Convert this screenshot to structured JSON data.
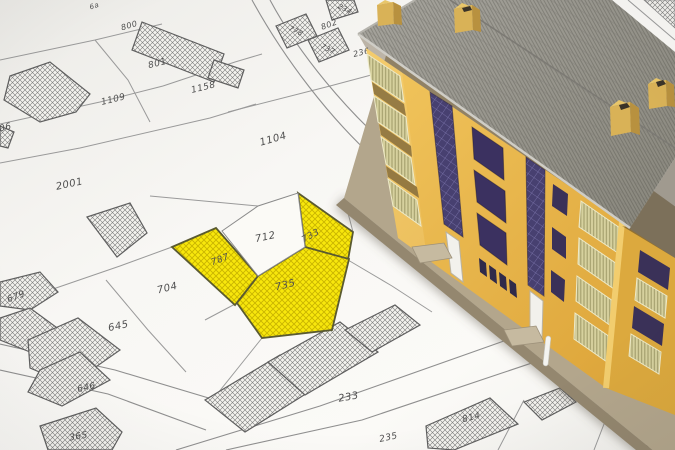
{
  "scene": {
    "title": "Model apartment building on cadastral map",
    "description": "Miniature multi-storey model house standing on a black-and-white cadastral plan; parcels 787, 733 and 735 are highlighted yellow around white parcel 712."
  },
  "map": {
    "paper_color": "#f7f6f2",
    "line_color": "#9a9a9a",
    "footprint_fill": "#f3f2ee",
    "hatch_line_color": "#7b7b7b",
    "hatch_outline_color": "#5f5f5f",
    "highlight": {
      "fill": "#f8e70c",
      "hatch": "#c9b400",
      "outline": "#5a5a30",
      "parcels": [
        "787",
        "733",
        "735"
      ],
      "surrounded_parcel": "712"
    },
    "labels": [
      {
        "text": "6a",
        "x": 95,
        "y": 8,
        "rot": -18,
        "size": 7
      },
      {
        "text": "800",
        "x": 130,
        "y": 28,
        "rot": -16,
        "size": 8
      },
      {
        "text": "802",
        "x": 330,
        "y": 27,
        "rot": -20,
        "size": 8
      },
      {
        "text": "801",
        "x": 158,
        "y": 66,
        "rot": -14,
        "size": 9
      },
      {
        "text": "1158",
        "x": 204,
        "y": 90,
        "rot": -14,
        "size": 9
      },
      {
        "text": "1109",
        "x": 114,
        "y": 102,
        "rot": -14,
        "size": 9
      },
      {
        "text": "06",
        "x": 6,
        "y": 130,
        "rot": -14,
        "size": 9
      },
      {
        "text": "1104",
        "x": 274,
        "y": 142,
        "rot": -16,
        "size": 10
      },
      {
        "text": "2001",
        "x": 70,
        "y": 187,
        "rot": -12,
        "size": 10
      },
      {
        "text": "234",
        "x": 344,
        "y": 11,
        "rot": 26,
        "size": 7
      },
      {
        "text": "778",
        "x": 295,
        "y": 33,
        "rot": 26,
        "size": 7
      },
      {
        "text": "737",
        "x": 327,
        "y": 51,
        "rot": 26,
        "size": 7
      },
      {
        "text": "236",
        "x": 362,
        "y": 55,
        "rot": -14,
        "size": 8
      },
      {
        "text": "712",
        "x": 266,
        "y": 240,
        "rot": -12,
        "size": 10
      },
      {
        "text": "733",
        "x": 312,
        "y": 238,
        "rot": -30,
        "size": 9
      },
      {
        "text": "787",
        "x": 221,
        "y": 262,
        "rot": -20,
        "size": 9
      },
      {
        "text": "735",
        "x": 286,
        "y": 288,
        "rot": -14,
        "size": 10
      },
      {
        "text": "704",
        "x": 168,
        "y": 291,
        "rot": -14,
        "size": 10
      },
      {
        "text": "679",
        "x": 17,
        "y": 299,
        "rot": -20,
        "size": 9
      },
      {
        "text": "645",
        "x": 119,
        "y": 329,
        "rot": -12,
        "size": 10
      },
      {
        "text": "646",
        "x": 87,
        "y": 390,
        "rot": -12,
        "size": 9
      },
      {
        "text": "365",
        "x": 79,
        "y": 439,
        "rot": -10,
        "size": 9
      },
      {
        "text": "233",
        "x": 349,
        "y": 400,
        "rot": -10,
        "size": 10
      },
      {
        "text": "235",
        "x": 389,
        "y": 440,
        "rot": -12,
        "size": 9
      },
      {
        "text": "814",
        "x": 472,
        "y": 420,
        "rot": -14,
        "size": 9
      },
      {
        "text": "230",
        "x": 655,
        "y": 445,
        "rot": -12,
        "size": 9
      }
    ]
  },
  "building": {
    "roof": {
      "color": "#9b9993",
      "ridge_color": "#7c7a74",
      "chimney_front": "#d9b257",
      "chimney_side": "#b8913f",
      "chimney_top": "#e8c66a",
      "chimney_count": 4
    },
    "walls": {
      "front": "#eebd52",
      "end": "#dca93e",
      "edge_highlight": "#f2cd6e"
    },
    "windows": {
      "color": "#3b3160",
      "glazing": "#474070"
    },
    "balconies": {
      "railing": "#d6d19e",
      "rib": "#a39e6c"
    },
    "doors": {
      "color": "#f2f1ec"
    },
    "base": {
      "top": "#b3a68c",
      "front": "#94876f",
      "step": "#c6baa0",
      "pole": "#f4f4f0"
    }
  }
}
